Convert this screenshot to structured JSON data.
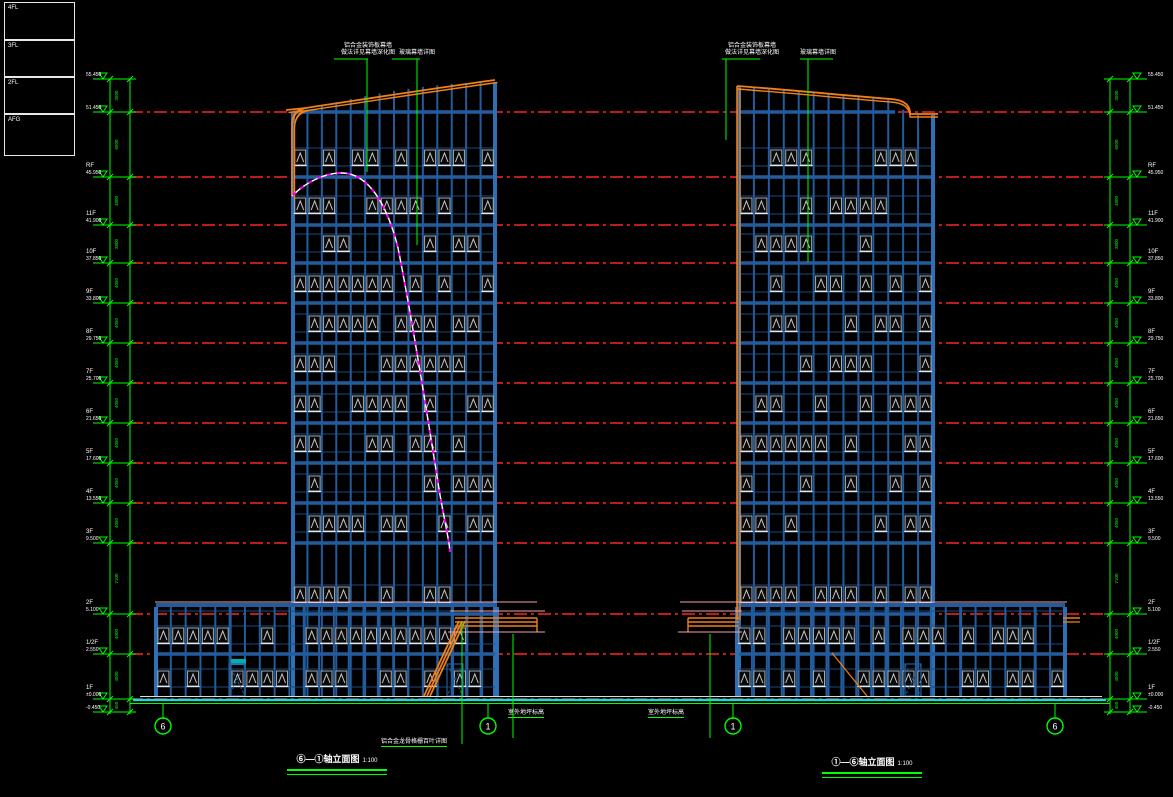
{
  "colors": {
    "background": "#000000",
    "dimension_green": "#00FF00",
    "level_red": "#FF2222",
    "curtainwall_blue": "#235C9C",
    "curtainwall_blue_dark": "#1A4A80",
    "facade_edge_blue": "#2F6FB4",
    "trim_orange": "#F08018",
    "seam_magenta": "#FF00FF",
    "ground_cyan": "#00E5E5",
    "slab_pink": "#F2A0A8",
    "window_gray": "#A8A8A8",
    "text_white": "#FFFFFF"
  },
  "sidebar_boxes": [
    "4FL",
    "3FL",
    "2FL",
    "AFG"
  ],
  "levels": [
    {
      "label": "",
      "elev": "55.450",
      "y": 79
    },
    {
      "label": "",
      "elev": "51.450",
      "y": 112
    },
    {
      "label": "RF",
      "elev": "45.950",
      "y": 177
    },
    {
      "label": "11F",
      "elev": "41.900",
      "y": 225
    },
    {
      "label": "10F",
      "elev": "37.850",
      "y": 263
    },
    {
      "label": "9F",
      "elev": "33.800",
      "y": 303
    },
    {
      "label": "8F",
      "elev": "29.750",
      "y": 343
    },
    {
      "label": "7F",
      "elev": "25.700",
      "y": 383
    },
    {
      "label": "6F",
      "elev": "21.650",
      "y": 423
    },
    {
      "label": "5F",
      "elev": "17.600",
      "y": 463
    },
    {
      "label": "4F",
      "elev": "13.550",
      "y": 503
    },
    {
      "label": "3F",
      "elev": "9.500",
      "y": 543
    },
    {
      "label": "2F",
      "elev": "5.100",
      "y": 614
    },
    {
      "label": "1/2F",
      "elev": "2.550",
      "y": 654
    },
    {
      "label": "1F",
      "elev": "±0.000",
      "y": 699
    },
    {
      "label": "",
      "elev": "-0.450",
      "y": 712
    }
  ],
  "dim_values": [
    "3500",
    "6500",
    "4800",
    "3800",
    "4050",
    "4050",
    "4050",
    "4050",
    "4050",
    "4050",
    "4050",
    "7100",
    "4000",
    "4500",
    "450"
  ],
  "bubbles": [
    {
      "label": "6",
      "x": 163
    },
    {
      "label": "1",
      "x": 488
    },
    {
      "label": "1",
      "x": 733
    },
    {
      "label": "6",
      "x": 1055
    }
  ],
  "ann": {
    "l1a": "铝合金装饰板幕墙",
    "l1b": "做法详见幕墙深化图",
    "l2": "玻璃幕墙详图",
    "r1a": "铝合金装饰板幕墙",
    "r1b": "做法详见幕墙深化图",
    "r2": "玻璃幕墙详图"
  },
  "notes": {
    "grille": "铝合金龙骨格栅百叶详图",
    "ground1": "室外地坪标高",
    "ground2": "室外地坪标高"
  },
  "titles": [
    {
      "text": "⑥—①轴立面图",
      "scale": "1:100"
    },
    {
      "text": "①—⑥轴立面图",
      "scale": "1:100"
    }
  ]
}
